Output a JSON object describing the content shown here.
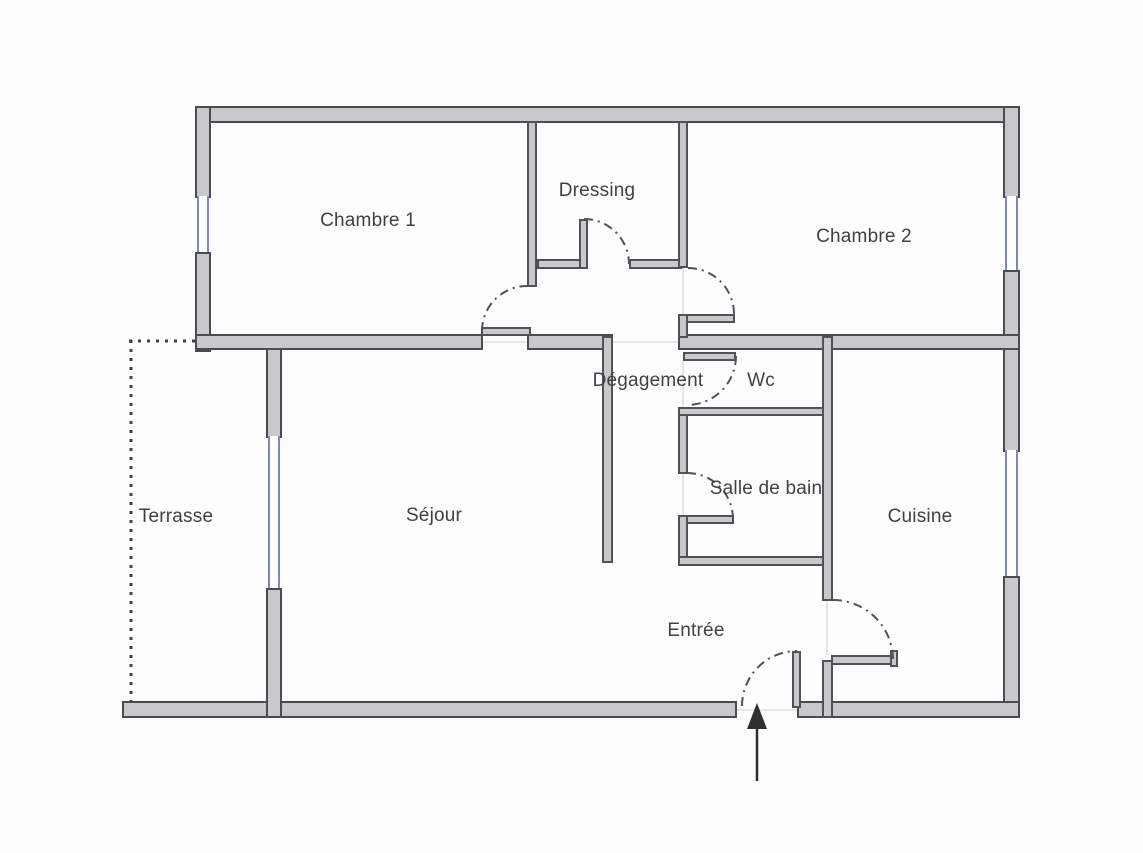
{
  "floor_plan": {
    "rooms": {
      "chambre1": {
        "label": "Chambre 1"
      },
      "dressing": {
        "label": "Dressing"
      },
      "chambre2": {
        "label": "Chambre 2"
      },
      "degagement": {
        "label": "Dégagement"
      },
      "wc": {
        "label": "Wc"
      },
      "salle_de_bain": {
        "label": "Salle de bain"
      },
      "terrasse": {
        "label": "Terrasse"
      },
      "sejour": {
        "label": "Séjour"
      },
      "cuisine": {
        "label": "Cuisine"
      },
      "entree": {
        "label": "Entrée"
      }
    },
    "colors": {
      "wall_fill": "#c9c9cc",
      "wall_outline": "#4b4c51",
      "window_glass": "#8287bb",
      "door_arc": "#515256",
      "terrace_dotted_line": "#3f4144",
      "label_text": "#3f4144",
      "background": "#fdfdfd"
    },
    "symbols": {
      "entrance_arrow": "arrow pointing up into entrance door opening"
    }
  }
}
